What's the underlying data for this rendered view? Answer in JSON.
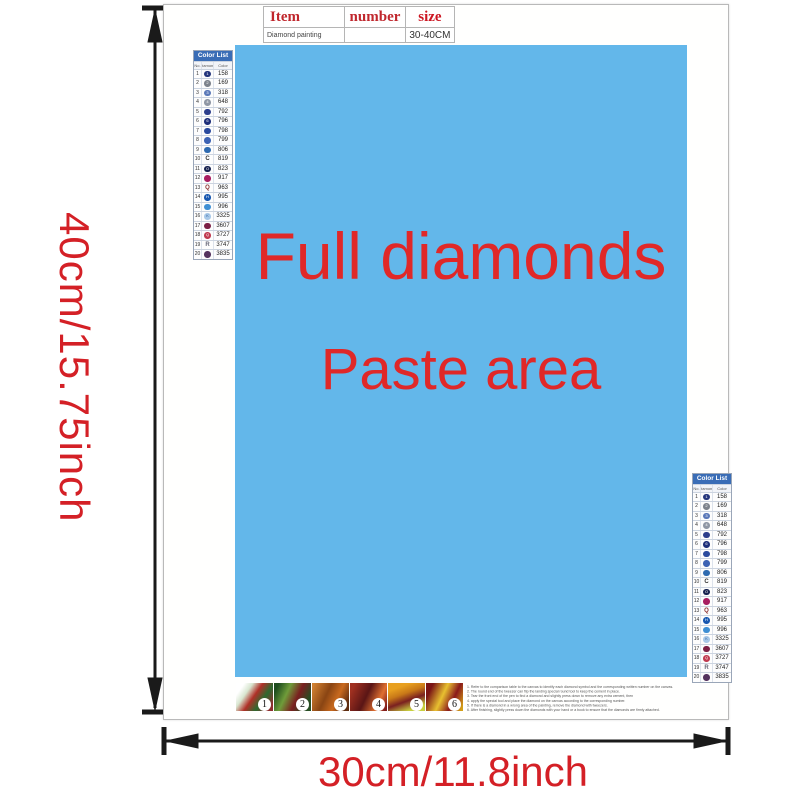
{
  "dimensions": {
    "height_label": "40cm/15.75inch",
    "width_label": "30cm/11.8inch",
    "text_color": "#d42026",
    "arrow_color": "#1a1a1a"
  },
  "item_table": {
    "headers": [
      "Item",
      "number",
      "size"
    ],
    "row": {
      "item": "Diamond painting",
      "number": "",
      "size": "30-40CM"
    }
  },
  "paste_area": {
    "line1": "Full diamonds",
    "line2": "Paste area",
    "bg_color": "#63b7ea",
    "text_color": "#e02828"
  },
  "color_list": {
    "title": "Color List",
    "columns": [
      "No.",
      "Diamond",
      "Color"
    ],
    "rows": [
      {
        "no": "1",
        "kind": "circle",
        "color": "#24357c",
        "glyph": "1",
        "code": "158"
      },
      {
        "no": "2",
        "kind": "circle",
        "color": "#7d838c",
        "glyph": "2",
        "code": "169"
      },
      {
        "no": "3",
        "kind": "circle",
        "color": "#5a78b8",
        "glyph": "3",
        "code": "318"
      },
      {
        "no": "4",
        "kind": "circle",
        "color": "#8f97a5",
        "glyph": "4",
        "code": "648"
      },
      {
        "no": "5",
        "kind": "circle",
        "color": "#2c3e8c",
        "glyph": "",
        "code": "792"
      },
      {
        "no": "6",
        "kind": "circle",
        "color": "#1e2f7a",
        "glyph": "6",
        "code": "796"
      },
      {
        "no": "7",
        "kind": "circle",
        "color": "#2a4a9e",
        "glyph": "",
        "code": "798"
      },
      {
        "no": "8",
        "kind": "circle",
        "color": "#3d63b4",
        "glyph": "",
        "code": "799"
      },
      {
        "no": "9",
        "kind": "circle",
        "color": "#2e6ab0",
        "glyph": "",
        "code": "806"
      },
      {
        "no": "10",
        "kind": "letter",
        "color": "#333333",
        "glyph": "C",
        "code": "819"
      },
      {
        "no": "11",
        "kind": "circle",
        "color": "#16214e",
        "glyph": "O",
        "code": "823"
      },
      {
        "no": "12",
        "kind": "circle",
        "color": "#a81d60",
        "glyph": "",
        "code": "917"
      },
      {
        "no": "13",
        "kind": "letter",
        "color": "#8a2b2b",
        "glyph": "Q",
        "code": "963"
      },
      {
        "no": "14",
        "kind": "circle",
        "color": "#1857b0",
        "glyph": "H",
        "code": "995"
      },
      {
        "no": "15",
        "kind": "circle",
        "color": "#3f8fd4",
        "glyph": "",
        "code": "996"
      },
      {
        "no": "16",
        "kind": "circle",
        "color": "#a8c8e8",
        "glyph": "K",
        "glyph_color": "#3a6aa5",
        "code": "3325"
      },
      {
        "no": "17",
        "kind": "circle",
        "color": "#7c1f45",
        "glyph": "",
        "code": "3607"
      },
      {
        "no": "18",
        "kind": "circle",
        "color": "#c03a50",
        "glyph": "Q",
        "code": "3727"
      },
      {
        "no": "19",
        "kind": "letter",
        "color": "#666677",
        "glyph": "R",
        "code": "3747"
      },
      {
        "no": "20",
        "kind": "circle",
        "color": "#55335e",
        "glyph": "",
        "code": "3835"
      }
    ]
  },
  "footer": {
    "steps": [
      "1",
      "2",
      "3",
      "4",
      "5",
      "6"
    ],
    "instructions": [
      "1. Refer to the comparison table to the canvas to identify each diamond symbol and the corresponding written number on the canvas.",
      "2. The round end of the tweezer can flip the landing special round tool to keep the cement in place.",
      "3. Tear the front end of the pen to find a diamond and slightly press down to remove any extra cement, then",
      "4. apply the special tool and place the diamond on the canvas according to the corresponding number.",
      "5. If there is a diamond in a wrong area of the painting, remove the diamond with tweezers.",
      "6. After finishing, slightly press down the diamonds with your hand or a book to ensure that the diamonds are firmly attached."
    ]
  }
}
